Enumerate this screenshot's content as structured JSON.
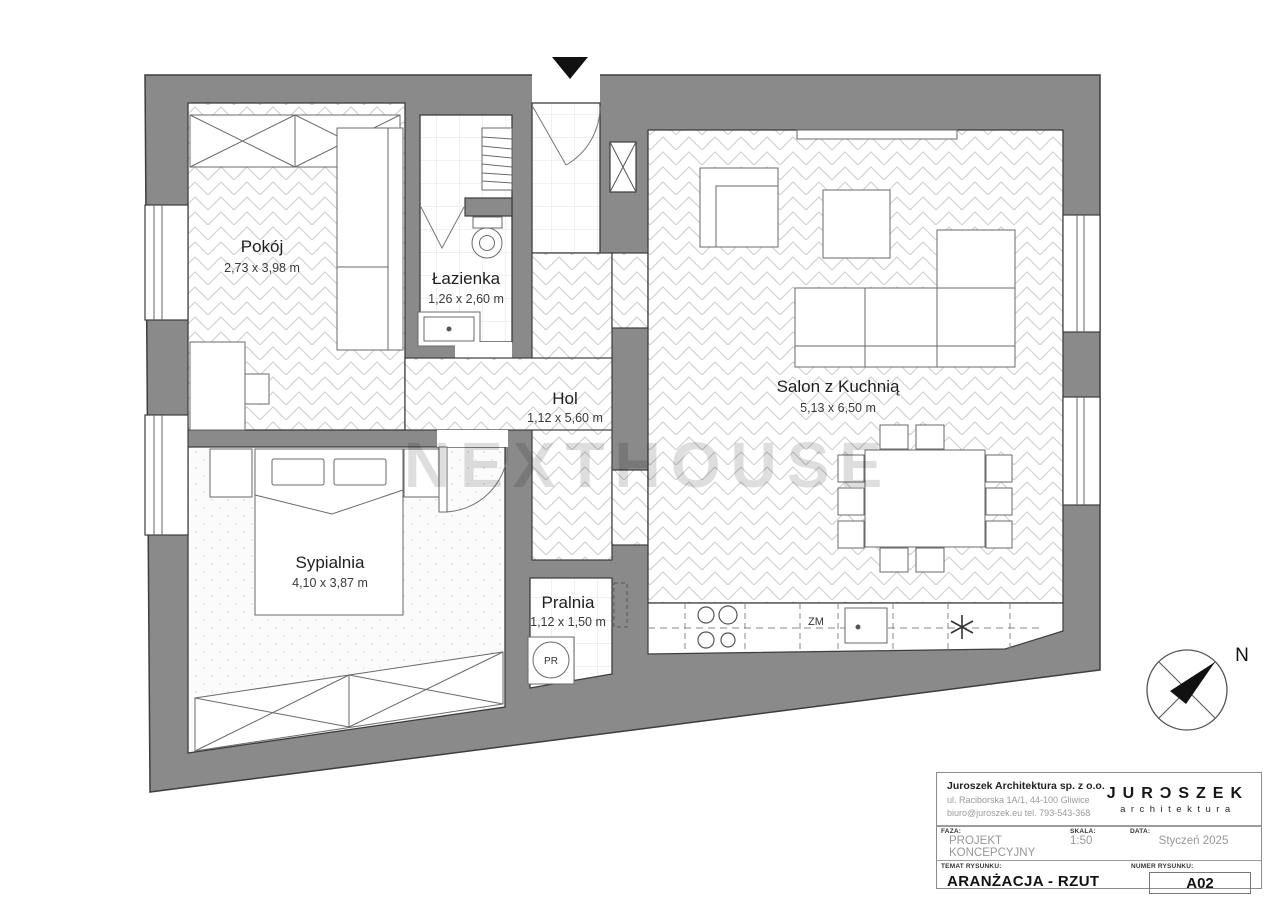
{
  "watermark": "NEXTHOUSE",
  "compass": {
    "north_label": "N"
  },
  "rooms": {
    "pokoj": {
      "name": "Pokój",
      "dimensions": "2,73 x 3,98 m"
    },
    "lazienka": {
      "name": "Łazienka",
      "dimensions": "1,26 x 2,60 m"
    },
    "hol": {
      "name": "Hol",
      "dimensions": "1,12 x 5,60 m"
    },
    "salon": {
      "name": "Salon z Kuchnią",
      "dimensions": "5,13 x 6,50 m"
    },
    "sypialnia": {
      "name": "Sypialnia",
      "dimensions": "4,10 x 3,87 m"
    },
    "pralnia": {
      "name": "Pralnia",
      "dimensions": "1,12 x 1,50 m"
    }
  },
  "appliances": {
    "dishwasher_label": "ZM",
    "washer_label": "PR"
  },
  "title_block": {
    "company": {
      "name": "Juroszek Architektura sp. z o.o.",
      "address": "ul. Raciborska 1A/1, 44-100 Gliwice",
      "contact": "biuro@juroszek.eu tel. 793-543-368"
    },
    "logo": {
      "brand": "JURƆSZEK",
      "sub": "architektura"
    },
    "faza": {
      "label": "FAZA:",
      "value": "PROJEKT KONCEPCYJNY"
    },
    "skala": {
      "label": "SKALA:",
      "value": "1:50"
    },
    "data": {
      "label": "DATA:",
      "value": "Styczeń 2025"
    },
    "temat": {
      "label": "TEMAT RYSUNKU:",
      "value": "ARANŻACJA - RZUT"
    },
    "numer": {
      "label": "NUMER RYSUNKU:",
      "value": "A02"
    }
  },
  "colors": {
    "wall": "#8a8a8a",
    "wall_edge": "#3d3d3d",
    "floor_pattern": "#cdcdcd"
  }
}
